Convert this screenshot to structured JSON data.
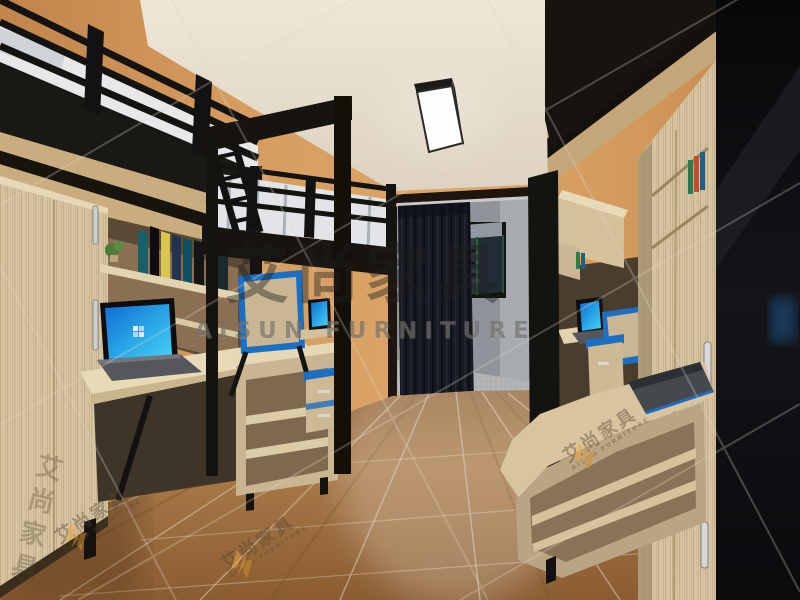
{
  "canvas": {
    "width": 800,
    "height": 600
  },
  "scene": {
    "type": "3d-interior-render",
    "description": "student dormitory room with black metal loft beds above desks, laptops with blue screens, light wood wardrobes and shelving, curtained balcony doorway, wood plank floor, ceiling LED panel light",
    "objects": [
      "left loft bed with white mattress and black railing",
      "left wardrobe with silver handles",
      "left desk with open laptop showing blue desktop",
      "bookshelf with colorful books and small plant",
      "corner open shelf unit",
      "second loft bed with ladder and striped mattress",
      "chair with blue trim",
      "drawer cabinet with blue trim",
      "balcony doorway with dark curtain on silver rail",
      "window with dark green frame",
      "gray balcony floor",
      "ceiling LED panel light",
      "right loft bed underside with wood slats",
      "right desk with laptop showing blue screen",
      "right tall wardrobe bookcase with silver handles",
      "foreground corner desk with dark laptop and open shelves",
      "dark side panel far right",
      "diagonal wood plank floor"
    ]
  },
  "watermark": {
    "brand_cn": "艾尚家具",
    "brand_en": "AISUN FURNITURE",
    "stamp_cn": "艾尚家具",
    "stamp_en": "AISUN FURNITURE"
  },
  "colors": {
    "wall_orange": "#d49a5e",
    "ceiling_cream": "#eae1d3",
    "wood_light": "#d8c7a5",
    "wood_dark": "#6e5a40",
    "metal_black": "#17140f",
    "floor_brown": "#a67644",
    "screen_blue": "#2aa7e8",
    "accent_blue": "#1d6fc2",
    "curtain_navy": "#171a22",
    "mattress_white": "#e8e9eb",
    "stamp_orange": "#eda63e"
  }
}
